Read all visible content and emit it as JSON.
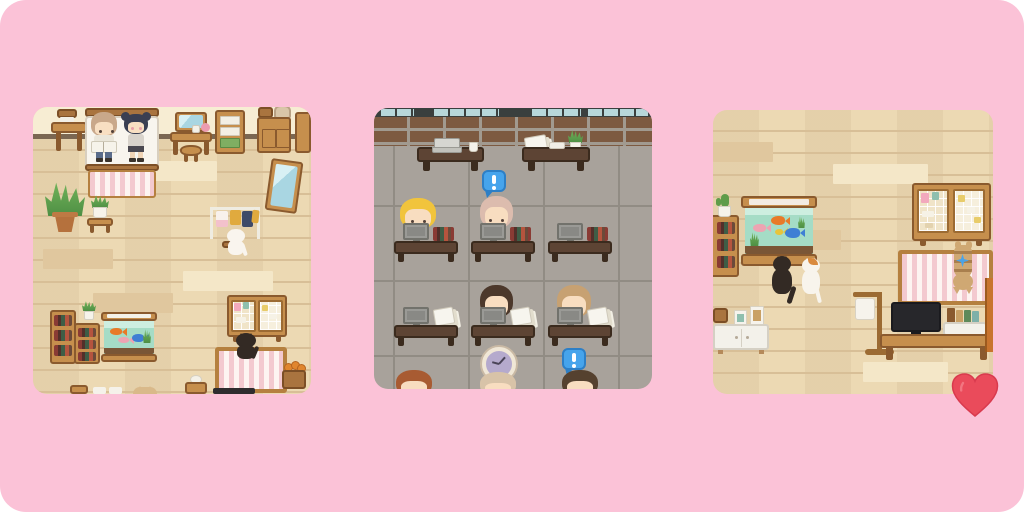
{
  "page": {
    "type": "pixel-art room screenshot collage",
    "background_color": "#fbc2d7",
    "description": "Three rounded square pixel-art game room screenshots on a pink background with a red heart sticker at the bottom right"
  },
  "panels": [
    {
      "id": "bedroom-left",
      "description": "Pixel-art bedroom with cream wall and wooden plank floor: two characters standing on a white bed with striped blanket, side table with books, vanity with mirror and stool, dresser, cabinets, leaning floor mirror, potted plants, clothes rack with garments, white cat, bookshelf, aquarium with fish, wire memo boards with sticky notes, black cat on a pink striped pet bed, basket of oranges",
      "items": [
        "side table with books",
        "bed",
        "boy character reading a book",
        "girl character with hair buns",
        "vanity with mirror",
        "stool",
        "dresser with white drawers and green bin",
        "cabinet with box and bag on top",
        "leaning floor mirror",
        "large potted plant",
        "small plant on stool",
        "clothes rack with white, yellow and navy garments",
        "white cat",
        "bookshelf with colorful books",
        "potted plant on shelf",
        "aquarium with orange, pink and blue fish",
        "wire memo boards with pink, teal, white and yellow notes",
        "black cat",
        "pink striped pet bed",
        "basket of oranges",
        "wooden stand",
        "tan cat peeking at bottom edge"
      ]
    },
    {
      "id": "office-middle",
      "description": "Pixel-art office with brick wall, windows and gray tiled floor: walnut sideboards holding a laptop with coffee mug and papers with a plant, two rows of three desks with monitors, books and paper stacks, seated characters with blonde, pink-beige, dark brown and light brown hair, three more characters partially visible at the bottom, two blue exclamation speech bubbles and a wall clock",
      "items": [
        "windows",
        "brick wall",
        "sideboard with laptop and coffee mug",
        "sideboard with papers, tray and potted plant",
        "desk with monitor and books",
        "desk with monitor and books",
        "desk with monitor and books",
        "desk with monitor and paper stack",
        "desk with monitor and paper stack",
        "desk with monitor and paper stack",
        "round clock",
        "speech bubble",
        "speech bubble"
      ],
      "characters": [
        {
          "hair": "blonde"
        },
        {
          "hair": "pink-beige",
          "speech_bubble": "!"
        },
        {
          "hair": "dark brown"
        },
        {
          "hair": "light brown"
        },
        {
          "hair": "auburn",
          "partial": true
        },
        {
          "hair": "beige",
          "partial": true
        },
        {
          "hair": "dark brown",
          "partial": true,
          "speech_bubble": "!"
        }
      ],
      "speech_bubble_symbol": "!"
    },
    {
      "id": "livingroom-right",
      "description": "Pixel-art living room with wooden plank floor: bookshelf with cactus, large aquarium with fish watched by a black cat and a white cat, wire memo boards with sticky notes, pink striped rug with a lounging tabby cat and a blue sparkle, white sideboard with picture frames, arched floor lamp, television on a wooden stand with a desk organizer",
      "items": [
        "bookshelf with books",
        "cactus in white pot",
        "large aquarium with orange, gold, pink and blue fish",
        "black cat watching aquarium",
        "white cat with orange patch watching aquarium",
        "wire memo boards with sticky notes",
        "pink striped rug",
        "tabby cat lounging",
        "blue sparkle",
        "white sideboard",
        "picture frames and box",
        "arched floor lamp",
        "television",
        "TV stand",
        "desk organizer with bottles and books",
        "tall orange shelf at right edge"
      ]
    }
  ],
  "heart_sticker": {
    "label": "red heart sticker",
    "color": "#ea4b5b"
  },
  "palette": {
    "background_pink": "#fbc2d7",
    "floor_wood_tan": "#ecd9b3",
    "wall_cream": "#f7edd3",
    "office_floor_gray": "#a8a29b",
    "brick_brown": "#7d5a41",
    "furniture_wood": "#c68f4d",
    "desk_walnut": "#5d4434",
    "speech_bubble_blue": "#46a4ec",
    "aquarium_teal": "#a5dcc6",
    "stripe_pink": "#f3c9cf",
    "heart_red": "#ea4b5b"
  }
}
